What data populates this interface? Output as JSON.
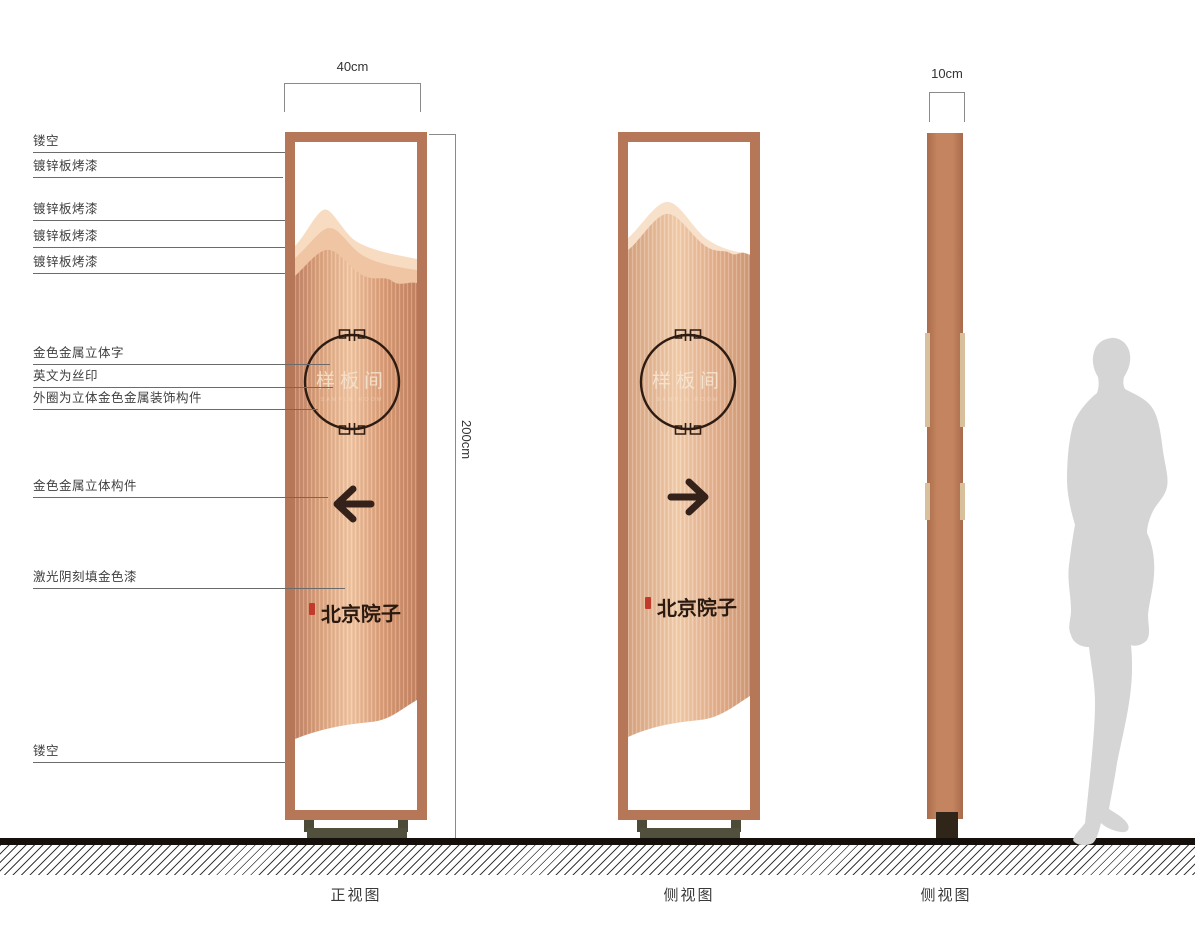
{
  "callouts": [
    {
      "text": "镂空"
    },
    {
      "text": "镀锌板烤漆"
    },
    {
      "text": "镀锌板烤漆"
    },
    {
      "text": "镀锌板烤漆"
    },
    {
      "text": "镀锌板烤漆"
    },
    {
      "text": "金色金属立体字"
    },
    {
      "text": "英文为丝印"
    },
    {
      "text": "外圈为立体金色金属装饰构件"
    },
    {
      "text": "金色金属立体构件"
    },
    {
      "text": "激光阴刻填金色漆"
    },
    {
      "text": "镂空"
    }
  ],
  "dimensions": {
    "front_width": "40cm",
    "height": "200cm",
    "side_depth": "10cm"
  },
  "sign": {
    "room_name": "样板间",
    "room_name_en": "SAMPLE ROOM",
    "brand_name": "北京院子"
  },
  "views": [
    {
      "label": "正视图"
    },
    {
      "label": "侧视图"
    },
    {
      "label": "侧视图"
    }
  ],
  "colors": {
    "frame_copper": "#b57758",
    "body_copper_light": "#f0c6a4",
    "body_copper_dark": "#c08266",
    "mountain_light": "#f7dcc2",
    "accent_dark": "#2e1c12",
    "seal_red": "#c23b2a",
    "protrusion_tan": "#d9c09c",
    "base_olive": "#4b4b38",
    "silhouette_gray": "#d5d5d5"
  }
}
